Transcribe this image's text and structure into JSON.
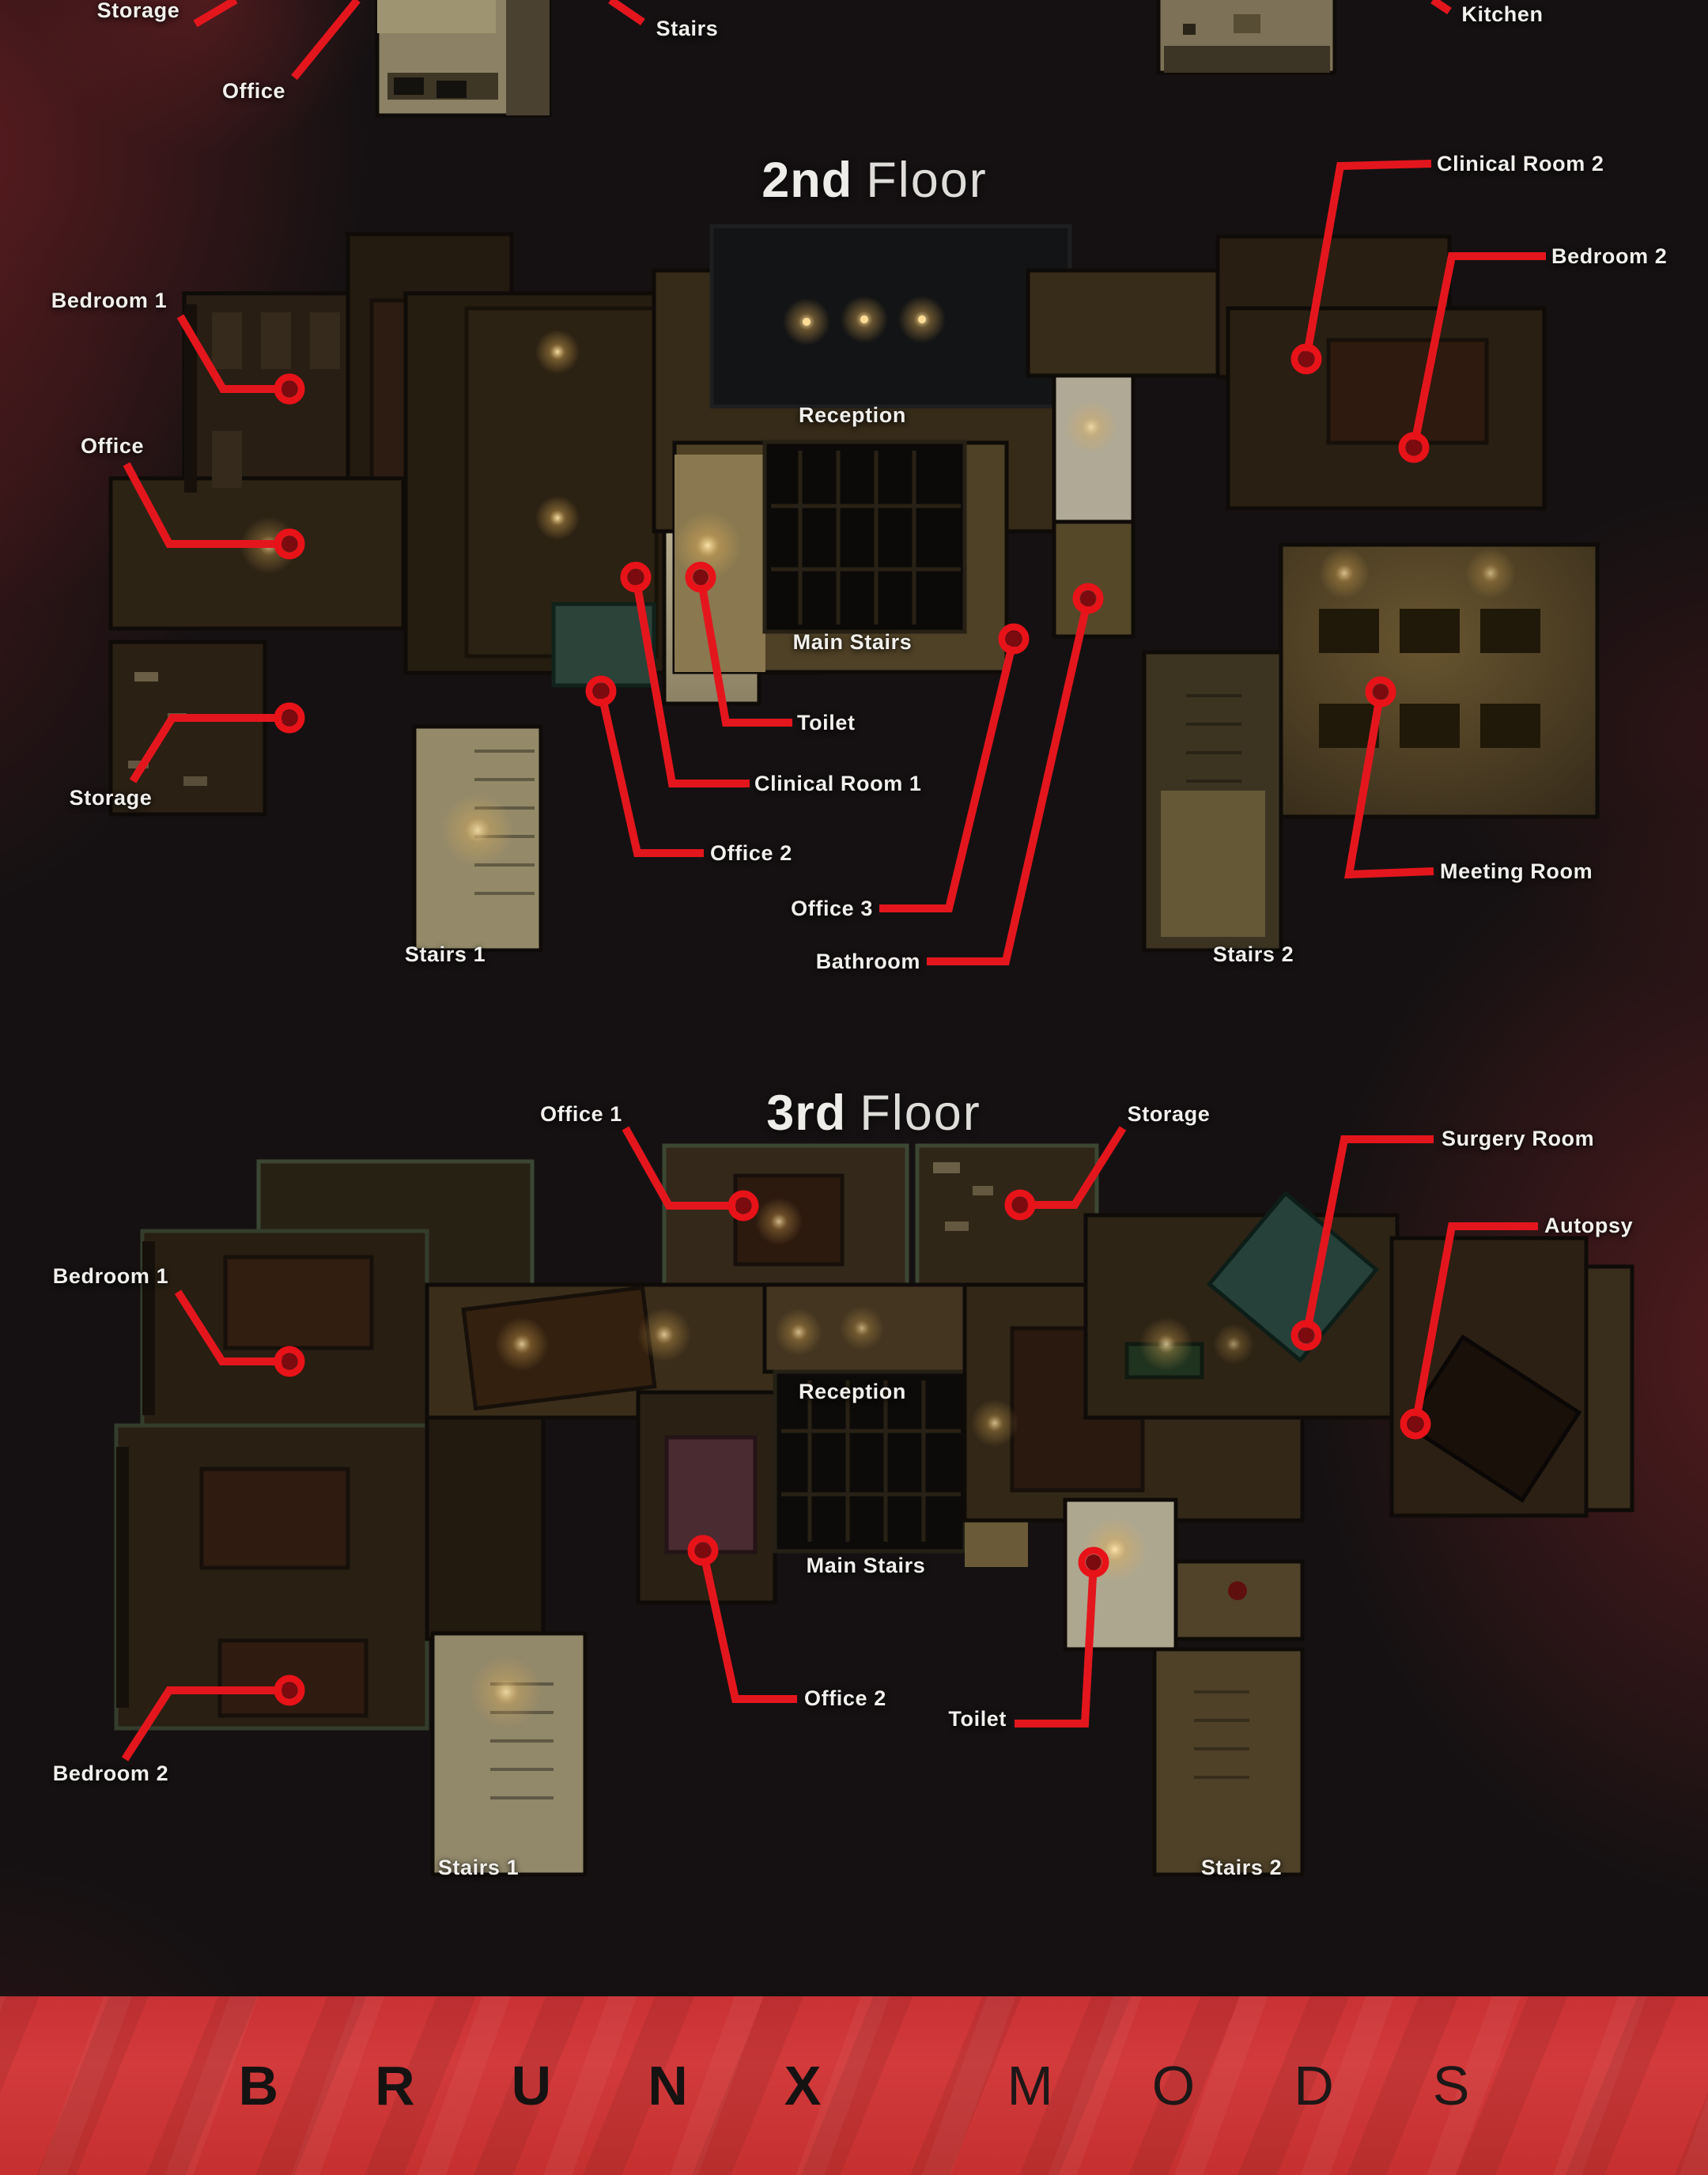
{
  "poster": {
    "top_floor": {
      "labels": {
        "storage": "Storage",
        "office": "Office",
        "stairs": "Stairs",
        "kitchen": "Kitchen"
      }
    },
    "floor2": {
      "title_bold": "2nd",
      "title_light": "Floor",
      "labels": {
        "bedroom1": "Bedroom 1",
        "office": "Office",
        "storage": "Storage",
        "stairs1": "Stairs 1",
        "stairs2": "Stairs 2",
        "reception": "Reception",
        "main_stairs": "Main Stairs",
        "toilet": "Toilet",
        "clinical_room_1": "Clinical Room 1",
        "office2": "Office 2",
        "office3": "Office 3",
        "bathroom": "Bathroom",
        "clinical_room_2": "Clinical Room 2",
        "bedroom2": "Bedroom 2",
        "meeting_room": "Meeting Room"
      }
    },
    "floor3": {
      "title_bold": "3rd",
      "title_light": "Floor",
      "labels": {
        "office1": "Office 1",
        "storage": "Storage",
        "surgery_room": "Surgery Room",
        "autopsy": "Autopsy",
        "bedroom1": "Bedroom 1",
        "reception": "Reception",
        "main_stairs": "Main Stairs",
        "office2": "Office 2",
        "toilet": "Toilet",
        "bedroom2": "Bedroom 2",
        "stairs1": "Stairs 1",
        "stairs2": "Stairs 2"
      }
    },
    "footer": {
      "brand_bold": "BRUNX",
      "brand_light": "MODS"
    },
    "colors": {
      "connector_red": "#e4161d",
      "marker_ring": "#e81219",
      "marker_core": "#7c0b10",
      "banner_red": "#cf3336",
      "label_white": "#f2f0ec"
    }
  }
}
